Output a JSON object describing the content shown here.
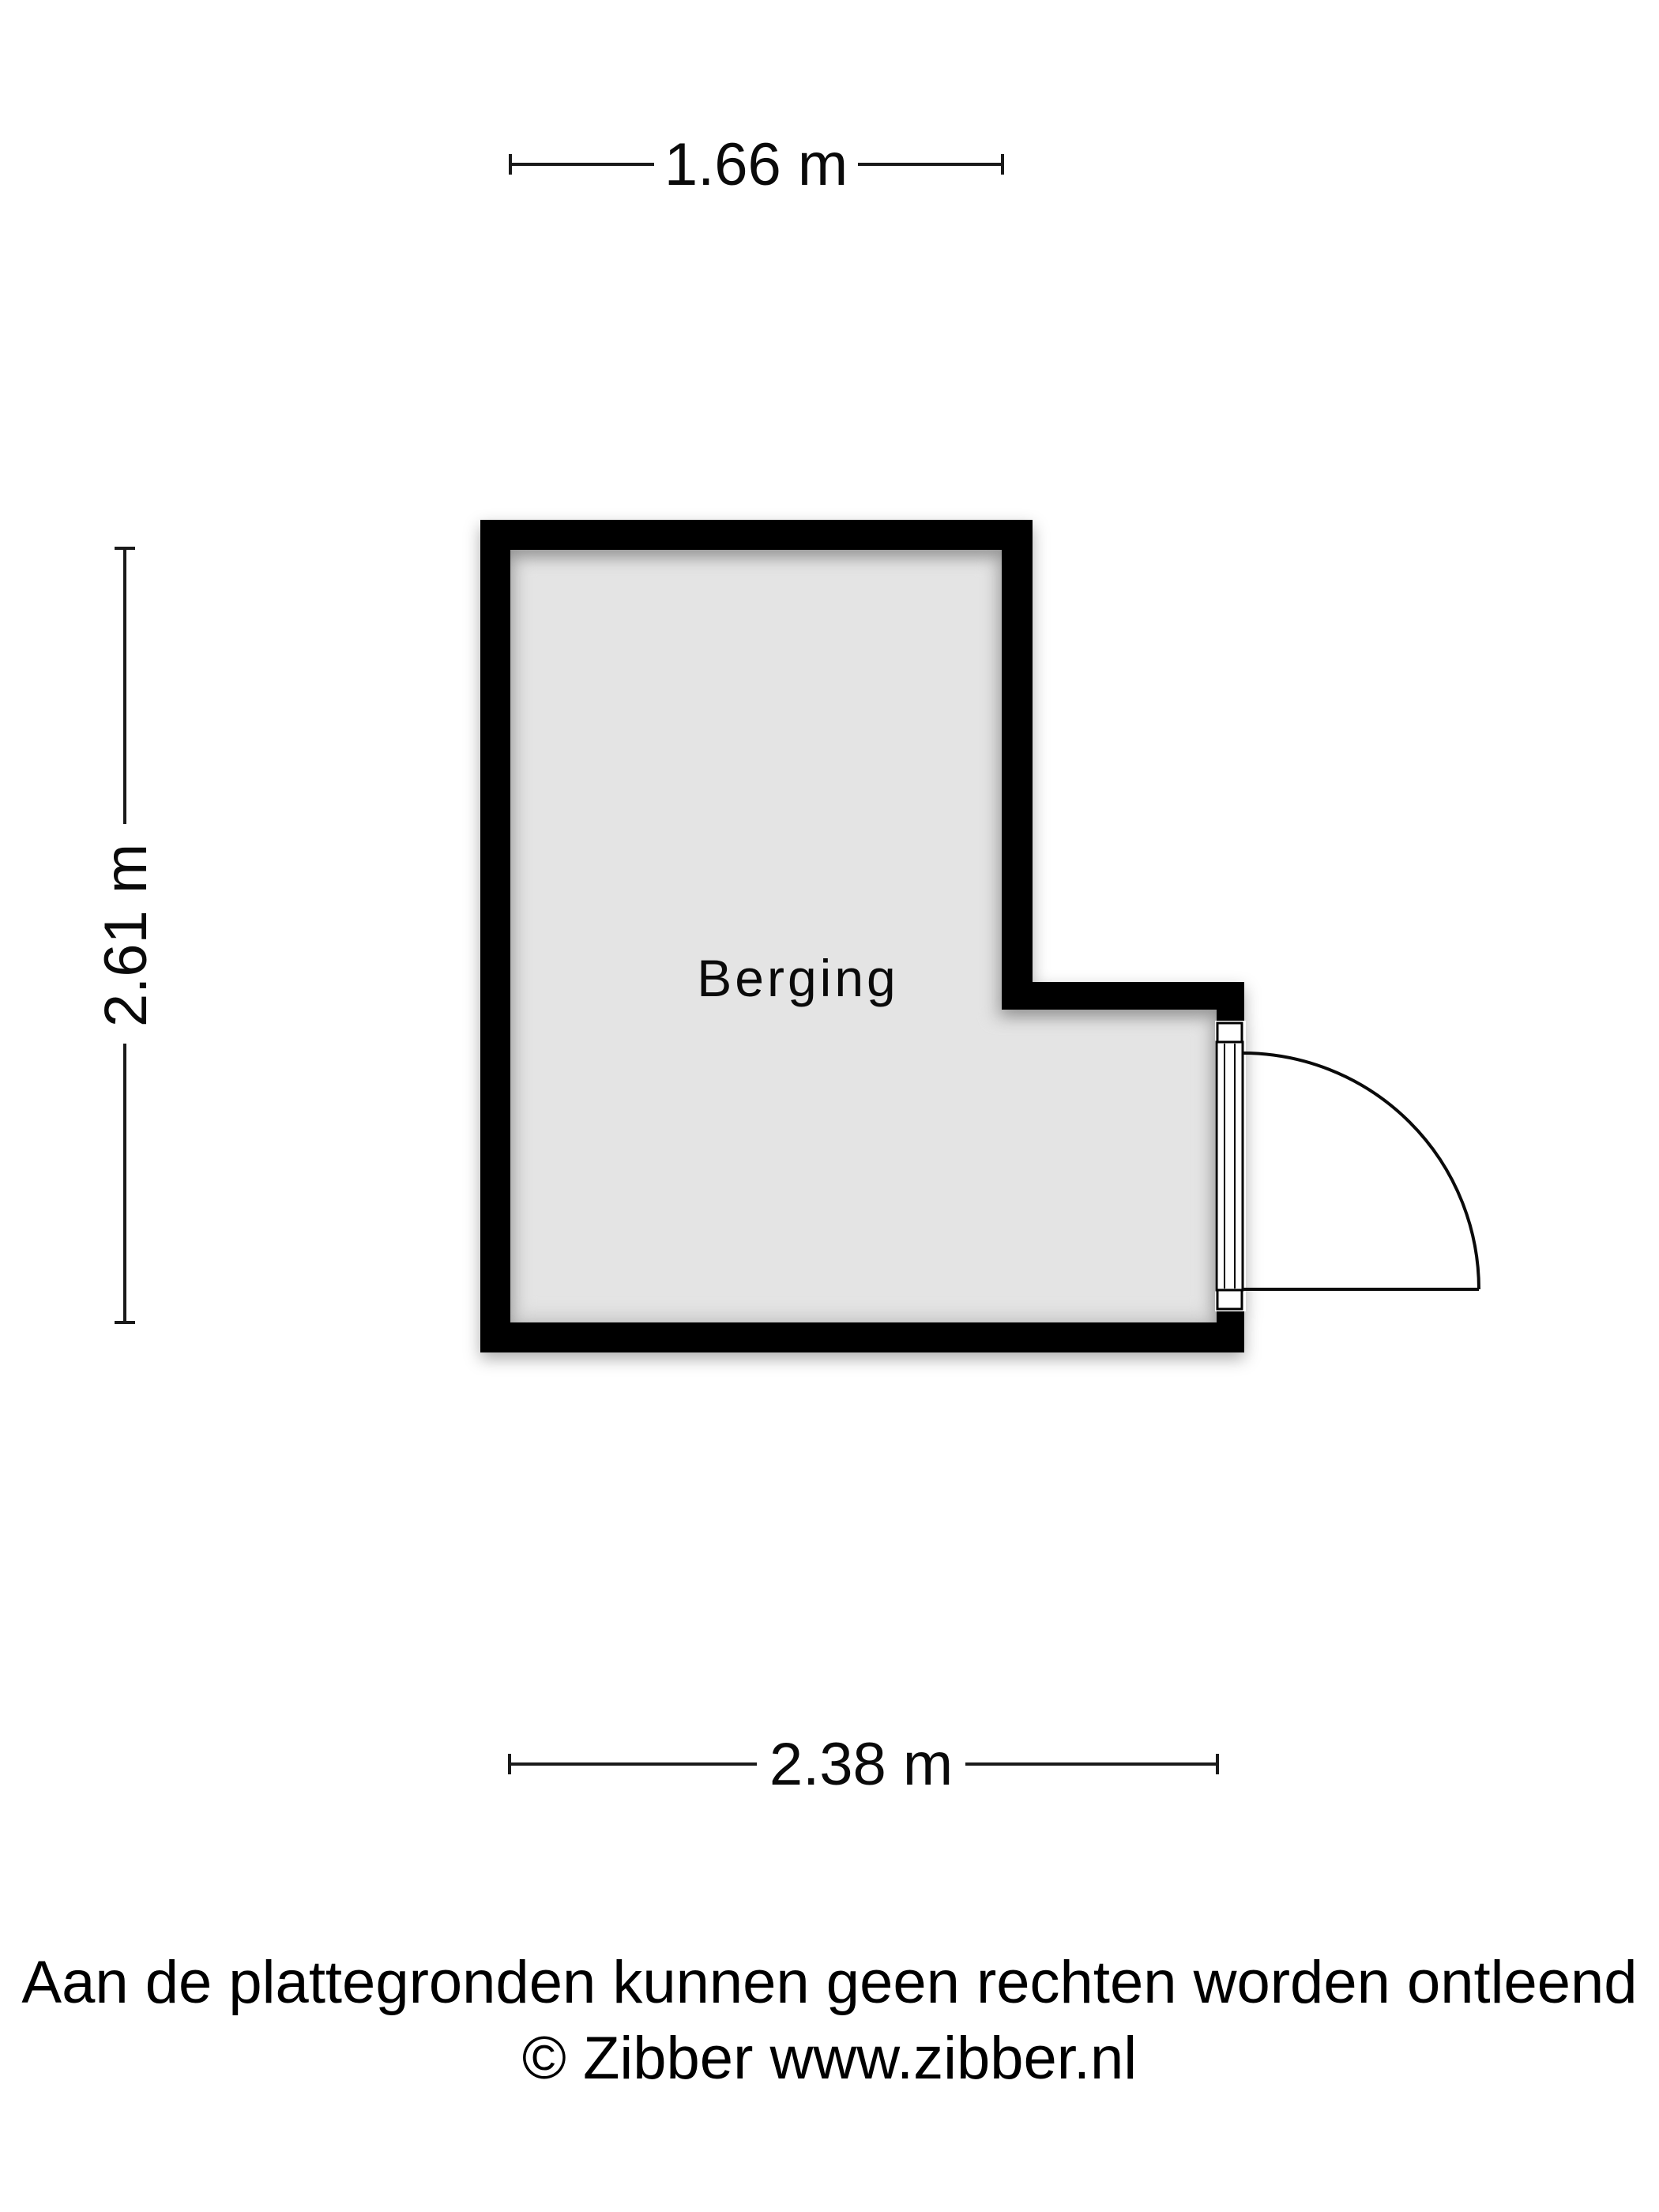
{
  "floorplan": {
    "room_label": "Berging",
    "dimensions": {
      "top": "1.66 m",
      "left": "2.61 m",
      "bottom": "2.38 m"
    },
    "colors": {
      "wall": "#000000",
      "floor": "#e4e4e4",
      "dimension_line": "#1a1a1a",
      "background": "#ffffff"
    }
  },
  "footer": {
    "disclaimer": "Aan de plattegronden kunnen geen rechten worden ontleend",
    "copyright": "© Zibber www.zibber.nl"
  }
}
